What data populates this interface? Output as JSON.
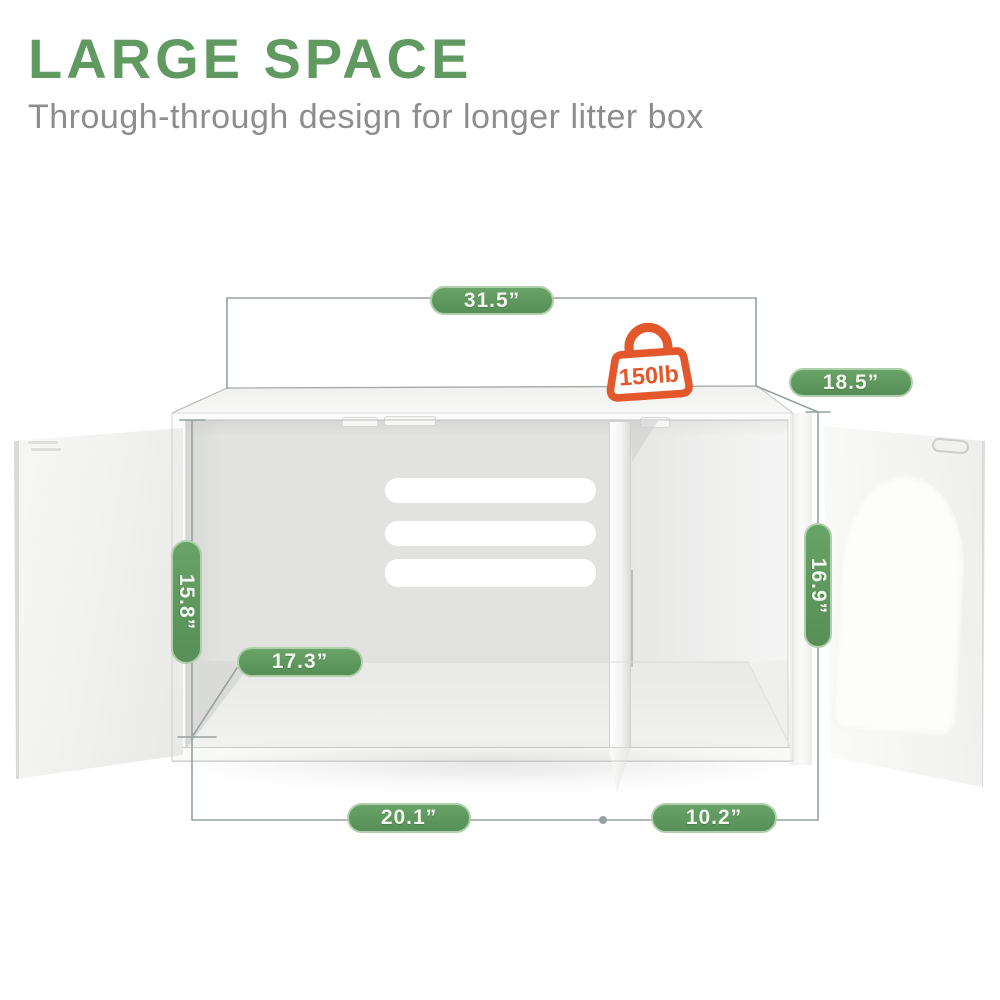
{
  "header": {
    "title": "LARGE SPACE",
    "subtitle": "Through-through design for longer litter box"
  },
  "capacity_badge": {
    "label": "150lb"
  },
  "dimensions": {
    "top_width": {
      "label": "31.5”"
    },
    "top_depth": {
      "label": "18.5”"
    },
    "left_height": {
      "label": "15.8”"
    },
    "right_height": {
      "label": "16.9”"
    },
    "interior_depth": {
      "label": "17.3”"
    },
    "left_compartment": {
      "label": "20.1”"
    },
    "right_compartment": {
      "label": "10.2”"
    }
  },
  "illustration": {
    "subject": "white litter box enclosure cabinet with two open doors, inner divider, vent slots and arched cat door",
    "icons": [
      "weight-capacity-bag-icon"
    ]
  },
  "colors": {
    "title_green": "#609a61",
    "badge_green": "#5d9a5d",
    "badge_border": "#aecfaa",
    "badge_text": "#f2f7ee",
    "subtitle_gray": "#8d8d8d",
    "capacity_orange": "#e4572b",
    "dimension_line": "#97a0a0"
  }
}
